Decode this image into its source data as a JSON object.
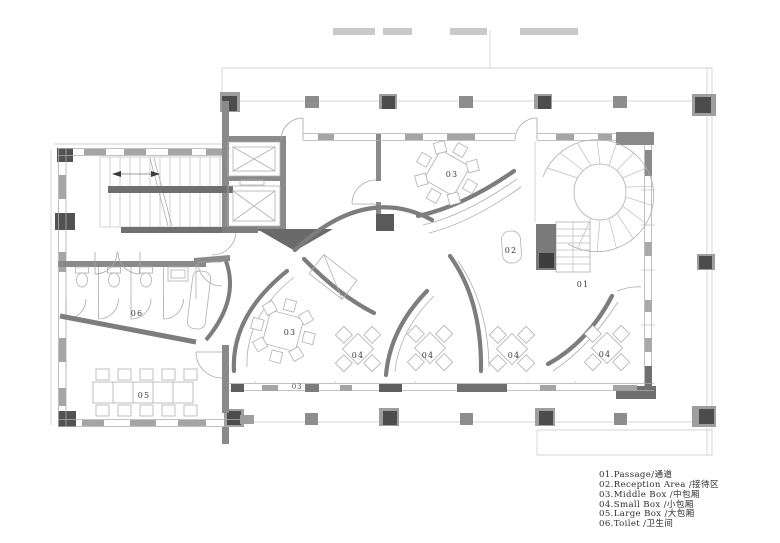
{
  "drawing": {
    "type": "floor-plan",
    "colors": {
      "wall": "#7d7d7d",
      "wall_band": "#8a8a8a",
      "dark_fill": "#4c4c4c",
      "window_fill": "#a5a5a5",
      "column_outer": "#9e9e9e",
      "text": "#3a3a3a"
    }
  },
  "plan": {
    "labels": [
      {
        "text": "01"
      },
      {
        "text": "02"
      },
      {
        "text": "03"
      },
      {
        "text": "03"
      },
      {
        "text": "04"
      },
      {
        "text": "04"
      },
      {
        "text": "04"
      },
      {
        "text": "04"
      },
      {
        "text": "05"
      },
      {
        "text": "06"
      },
      {
        "text": "03"
      }
    ]
  },
  "legend": {
    "items": [
      "01.Passage/通道",
      "02.Reception Area /接待区",
      "03.Middle Box /中包厢",
      "04.Small Box /小包厢",
      "05.Large Box /大包厢",
      "06.Toilet /卫生间"
    ]
  }
}
